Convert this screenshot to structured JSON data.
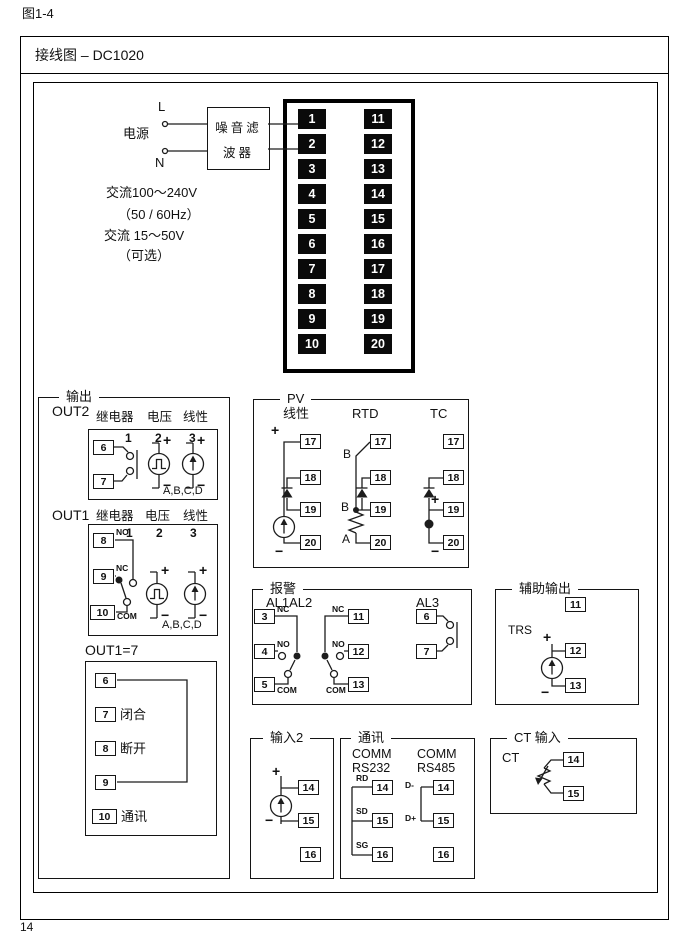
{
  "page": {
    "figure_label": "图1-4",
    "page_number": "14"
  },
  "header": {
    "title": "接线图 – DC1020"
  },
  "power": {
    "label": "电源",
    "l": "L",
    "n": "N",
    "filter_line1": "噪音滤",
    "filter_line2": "波器",
    "spec_1": "交流100～240V",
    "spec_2": "（50 / 60Hz）",
    "spec_3": "交流 15～50V",
    "spec_4": "（可选）"
  },
  "terminal_block": {
    "left": [
      "1",
      "2",
      "3",
      "4",
      "5",
      "6",
      "7",
      "8",
      "9",
      "10"
    ],
    "right": [
      "11",
      "12",
      "13",
      "14",
      "15",
      "16",
      "17",
      "18",
      "19",
      "20"
    ]
  },
  "output": {
    "title": "输出",
    "out2": {
      "label": "OUT2",
      "relay": "继电器",
      "voltage": "电压",
      "linear": "线性",
      "c1": "1",
      "c2": "2",
      "c3": "3",
      "t6": "6",
      "t7": "7",
      "plus_v": "+",
      "minus_v": "−",
      "plus_l": "+",
      "minus_l": "−",
      "abcd": "A,B,C,D"
    },
    "out1": {
      "label": "OUT1",
      "relay": "继电器",
      "voltage": "电压",
      "linear": "线性",
      "c1": "1",
      "c2": "2",
      "c3": "3",
      "t8": "8",
      "t9": "9",
      "t10": "10",
      "no": "NO",
      "nc": "NC",
      "com": "COM",
      "plus_v": "+",
      "minus_v": "−",
      "plus_l": "+",
      "minus_l": "−",
      "abcd": "A,B,C,D"
    },
    "out1_7": {
      "label": "OUT1=7",
      "t6": "6",
      "t7": "7",
      "t8": "8",
      "t9": "9",
      "t10": "10",
      "t7_text": "闭合",
      "t8_text": "断开",
      "t10_text": "通讯"
    }
  },
  "pv": {
    "title": "PV",
    "linear": {
      "label": "线性",
      "plus": "+",
      "minus": "−",
      "t17": "17",
      "t18": "18",
      "t19": "19",
      "t20": "20"
    },
    "rtd": {
      "label": "RTD",
      "b_top": "B",
      "b_mid": "B",
      "a": "A",
      "t17": "17",
      "t18": "18",
      "t19": "19",
      "t20": "20"
    },
    "tc": {
      "label": "TC",
      "plus": "+",
      "minus": "−",
      "t17": "17",
      "t18": "18",
      "t19": "19",
      "t20": "20"
    }
  },
  "alarm": {
    "title": "报警",
    "al12_label": "AL1AL2",
    "al3_label": "AL3",
    "al1": {
      "t3": "3",
      "t4": "4",
      "t5": "5",
      "nc": "NC",
      "no": "NO",
      "com": "COM"
    },
    "al2": {
      "t11": "11",
      "t12": "12",
      "t13": "13",
      "nc": "NC",
      "no": "NO",
      "com": "COM"
    },
    "al3": {
      "t6": "6",
      "t7": "7"
    }
  },
  "aux": {
    "title": "辅助输出",
    "trs": "TRS",
    "plus": "+",
    "minus": "−",
    "t11": "11",
    "t12": "12",
    "t13": "13"
  },
  "input2": {
    "title": "输入2",
    "plus": "+",
    "minus": "−",
    "t14": "14",
    "t15": "15",
    "t16": "16"
  },
  "comm": {
    "title": "通讯",
    "rs232": {
      "h1": "COMM",
      "h2": "RS232",
      "rd": "RD",
      "sd": "SD",
      "sg": "SG",
      "t14": "14",
      "t15": "15",
      "t16": "16"
    },
    "rs485": {
      "h1": "COMM",
      "h2": "RS485",
      "dminus": "D-",
      "dplus": "D+",
      "t14": "14",
      "t15": "15",
      "t16": "16"
    }
  },
  "ct": {
    "title": "CT 输入",
    "label": "CT",
    "t14": "14",
    "t15": "15"
  }
}
